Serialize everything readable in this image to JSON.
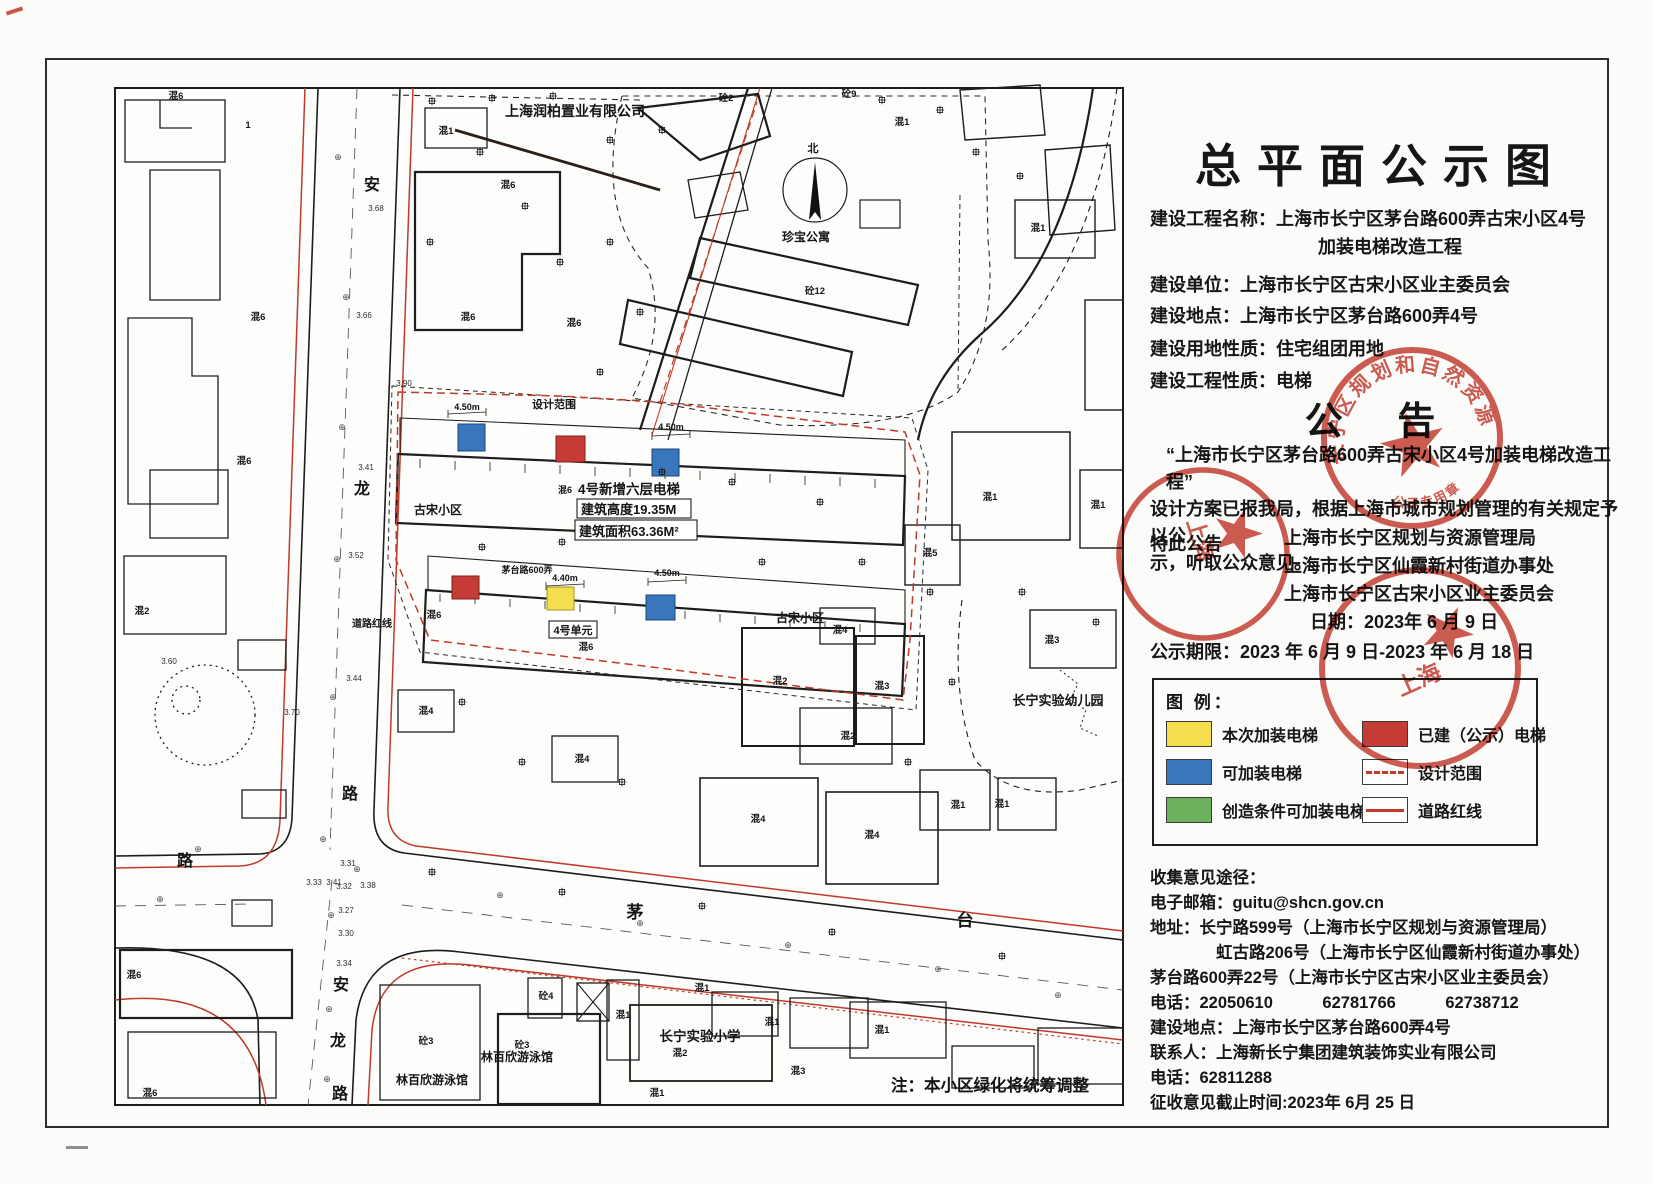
{
  "panel": {
    "title": "总平面公示图",
    "info": {
      "lines": [
        "建设工程名称：上海市长宁区茅台路600弄古宋小区4号",
        "加装电梯改造工程",
        "建设单位：上海市长宁区古宋小区业主委员会",
        "建设地点：上海市长宁区茅台路600弄4号",
        "建设用地性质：住宅组团用地",
        "建设工程性质：电梯"
      ]
    },
    "notice": {
      "heading": "公 告",
      "body": [
        "“上海市长宁区茅台路600弄古宋小区4号加装电梯改造工程”",
        "设计方案已报我局，根据上海市城市规划管理的有关规定予以公",
        "示，听取公众意见。"
      ],
      "proclaim": "特此公告",
      "issuers": [
        "上海市长宁区规划与资源管理局",
        "上海市长宁区仙霞新村街道办事处",
        "上海市长宁区古宋小区业主委员会"
      ],
      "date_line": "日期：2023年 6 月 9 日",
      "period_line": "公示期限：2023 年 6 月 9 日-2023 年 6 月 18 日"
    },
    "legend": {
      "heading": "图 例：",
      "col1": [
        {
          "label": "本次加装电梯",
          "color": "#f4de4d"
        },
        {
          "label": "可加装电梯",
          "color": "#3a76bb"
        },
        {
          "label": "创造条件可加装电梯",
          "color": "#6cb25d"
        }
      ],
      "col2": [
        {
          "label": "已建（公示）电梯",
          "color": "#c53b36"
        },
        {
          "label": "设计范围",
          "style": "dashed-red-line"
        },
        {
          "label": "道路红线",
          "style": "solid-red-line"
        }
      ]
    },
    "contact": {
      "heading": "收集意见途径：",
      "lines": [
        "电子邮箱：guitu@shcn.gov.cn",
        "地址：长宁路599号（上海市长宁区规划与资源管理局）",
        "虹古路206号（上海市长宁区仙霞新村街道办事处）",
        "茅台路600弄22号（上海市长宁区古宋小区业主委员会）",
        "电话：22050610　　　62781766　　　62738712",
        "建设地点：上海市长宁区茅台路600弄4号",
        "联系人：上海新长宁集团建筑装饰实业有限公司",
        "电话：62811288",
        "征收意见截止时间:2023年 6月 25 日"
      ]
    }
  },
  "stamps": [
    {
      "ring_text": "长宁区规划和自然资源",
      "bottom_text": "公示专用章",
      "color": "#c5372c"
    },
    {
      "fragment": "上海",
      "color": "#c5372c"
    },
    {
      "fragment": "上海",
      "color": "#c5372c"
    }
  ],
  "map": {
    "sym": "⊕",
    "company": "上海润柏置业有限公司",
    "apartment": "珍宝公寓",
    "north": "北",
    "roads": {
      "anlong_top": [
        "安",
        "龙",
        "路"
      ],
      "anlong_bottom": [
        "安",
        "龙",
        "路"
      ],
      "maotai": [
        "茅",
        "台"
      ],
      "west_lu": "路",
      "redline_label": "道路红线"
    },
    "scope_label": "设计范围",
    "estate": {
      "name1": "古宋小区",
      "name2": "古宋小区",
      "lane": "茅台路600弄",
      "prefix": "混6",
      "elevator_title": "4号新增六层电梯",
      "height": "建筑高度19.35M",
      "area": "建筑面积63.36M²",
      "unit": "4号单元",
      "dims": [
        "4.50m",
        "4.50m",
        "4.40m",
        "4.50m"
      ]
    },
    "facilities": {
      "kindergarten": "长宁实验幼儿园",
      "school": "长宁实验小学",
      "pool1": "林百欣游泳馆",
      "pool2": "林百欣游泳馆"
    },
    "note": "注：本小区绿化将统筹调整",
    "bldg_labels": [
      "混6",
      "1",
      "混6",
      "混6",
      "混2",
      "混6",
      "混6",
      "混6",
      "混6",
      "混6",
      "混6",
      "混6",
      "混1",
      "砼2",
      "砼9",
      "砼12",
      "混1",
      "混1",
      "混1",
      "混1",
      "混5",
      "混2",
      "混3",
      "混4",
      "混2",
      "混4",
      "混4",
      "混4",
      "混4",
      "混1",
      "混1",
      "混3",
      "砼4",
      "砼3",
      "砼3",
      "混1",
      "混1",
      "混1",
      "混1",
      "混2",
      "混3",
      "混1"
    ],
    "elevations": [
      "3.68",
      "3.66",
      "3.41",
      "3.52",
      "3.44",
      "3.70",
      "3.31",
      "3.33",
      "3.41",
      "3.32",
      "3.38",
      "3.27",
      "3.30",
      "3.34",
      "3.90",
      "3.60"
    ]
  }
}
